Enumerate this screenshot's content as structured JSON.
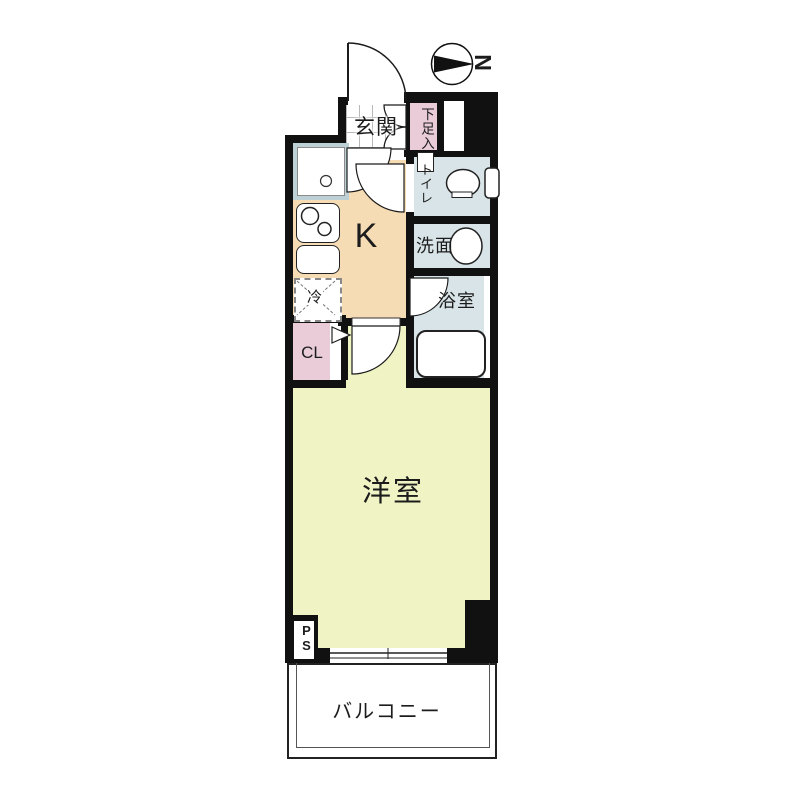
{
  "plan": {
    "compass": {
      "north_label": "N"
    },
    "rooms": {
      "entrance": {
        "label": "玄関"
      },
      "shoe_storage": {
        "label": "下足入"
      },
      "toilet": {
        "label": "トイレ"
      },
      "washroom": {
        "label": "洗面"
      },
      "bathroom": {
        "label": "浴室"
      },
      "kitchen": {
        "label": "K"
      },
      "refrigerator": {
        "label": "冷"
      },
      "closet": {
        "label": "CL"
      },
      "western_room": {
        "label": "洋室"
      },
      "balcony": {
        "label": "バルコニー"
      },
      "pipe_space": {
        "label": "PS"
      }
    },
    "colors": {
      "wall": "#111111",
      "room_pink": "#eaccd9",
      "room_blue": "#d8e4e7",
      "kitchen_tan": "#f6dcb4",
      "room_yellow": "#f0f3c4"
    }
  }
}
